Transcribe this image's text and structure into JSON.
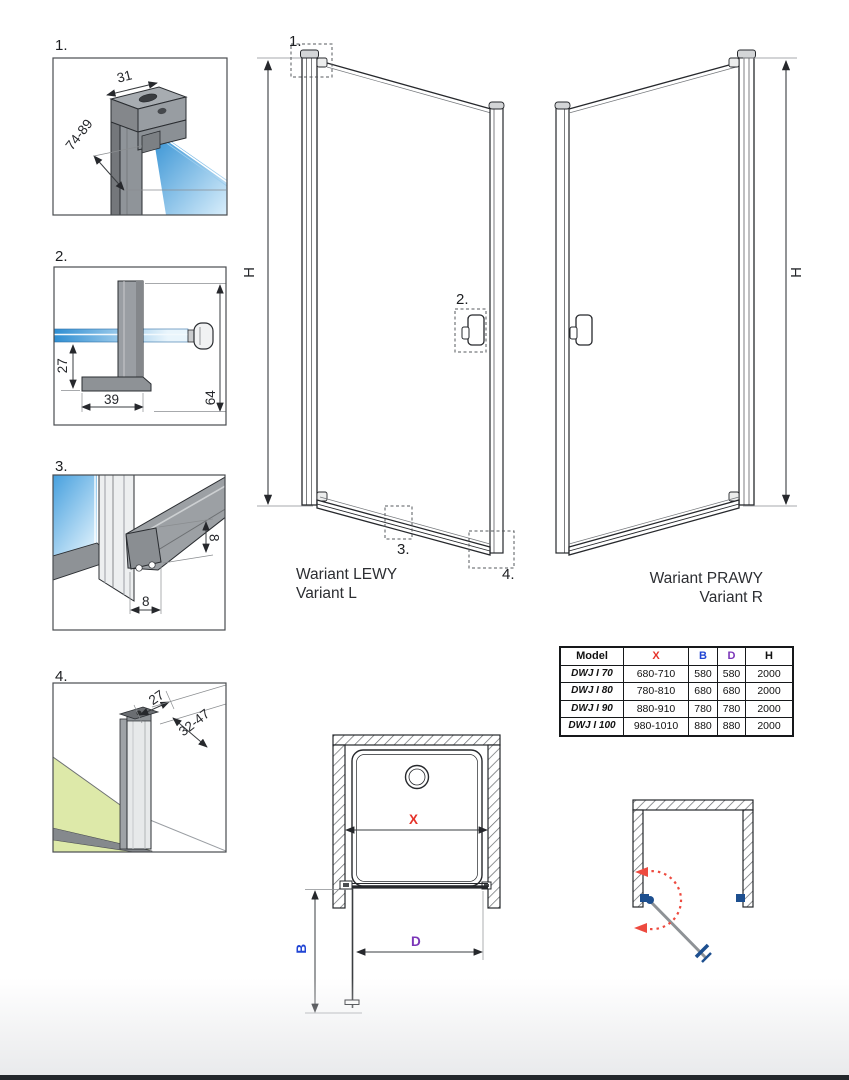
{
  "details": [
    {
      "label": "1.",
      "dim_profile_width": "31",
      "dim_adjust_range": "74-89"
    },
    {
      "label": "2.",
      "dim_offset": "27",
      "dim_handle_length": "39",
      "dim_total": "64"
    },
    {
      "label": "3.",
      "dim_seal_height": "8",
      "dim_seal_width": "8"
    },
    {
      "label": "4.",
      "dim_profile_width": "27",
      "dim_adjust_range": "32-47"
    }
  ],
  "elevations": {
    "left": {
      "label_pl": "Wariant LEWY",
      "label_en": "Variant L",
      "dim_height": "H",
      "callout_1": "1.",
      "callout_2": "2.",
      "callout_3": "3.",
      "callout_4": "4."
    },
    "right": {
      "label_pl": "Wariant PRAWY",
      "label_en": "Variant R",
      "dim_height": "H"
    }
  },
  "spec_table": {
    "headers": {
      "model": "Model",
      "x": "X",
      "b": "B",
      "d": "D",
      "h": "H"
    },
    "rows": [
      {
        "model": "DWJ I 70",
        "x": "680-710",
        "b": "580",
        "d": "580",
        "h": "2000"
      },
      {
        "model": "DWJ I 80",
        "x": "780-810",
        "b": "680",
        "d": "680",
        "h": "2000"
      },
      {
        "model": "DWJ I 90",
        "x": "880-910",
        "b": "780",
        "d": "780",
        "h": "2000"
      },
      {
        "model": "DWJ I 100",
        "x": "980-1010",
        "b": "880",
        "d": "880",
        "h": "2000"
      }
    ]
  },
  "plan": {
    "dim_width": "X",
    "dim_door_b": "B",
    "dim_door_d": "D"
  },
  "colors": {
    "glass_blue": "#2e8ed2",
    "glass_blue_light": "#d9eefb",
    "profile_gray": "#9a9ea3",
    "floor_green": "#dde9a9",
    "dim_x_red": "#e5332a",
    "dim_b_blue": "#2145d4",
    "dim_d_purple": "#7a35b8",
    "swing_red": "#ed4a3f",
    "hardware_blue": "#1d4f8f"
  }
}
